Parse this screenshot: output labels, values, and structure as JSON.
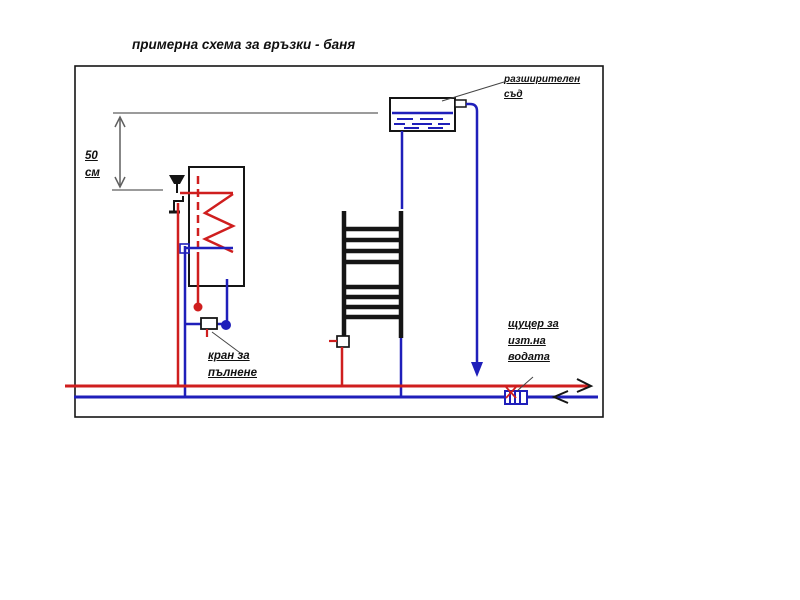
{
  "title": "примерна схема за връзки - баня",
  "colors": {
    "hot": "#cf1e1e",
    "cold": "#1f1fba",
    "ink": "#151515",
    "dim": "#5f5f5f"
  },
  "labels": {
    "dimension": {
      "value": "50",
      "unit": "см"
    },
    "expansion_tank": {
      "line1": "разширителен",
      "line2": "съд"
    },
    "fill_valve": {
      "line1": "кран за",
      "line2": "пълнене"
    },
    "drain_nozzle": {
      "line1": "щуцер за",
      "line2": "изт.на",
      "line3": "водата"
    }
  }
}
